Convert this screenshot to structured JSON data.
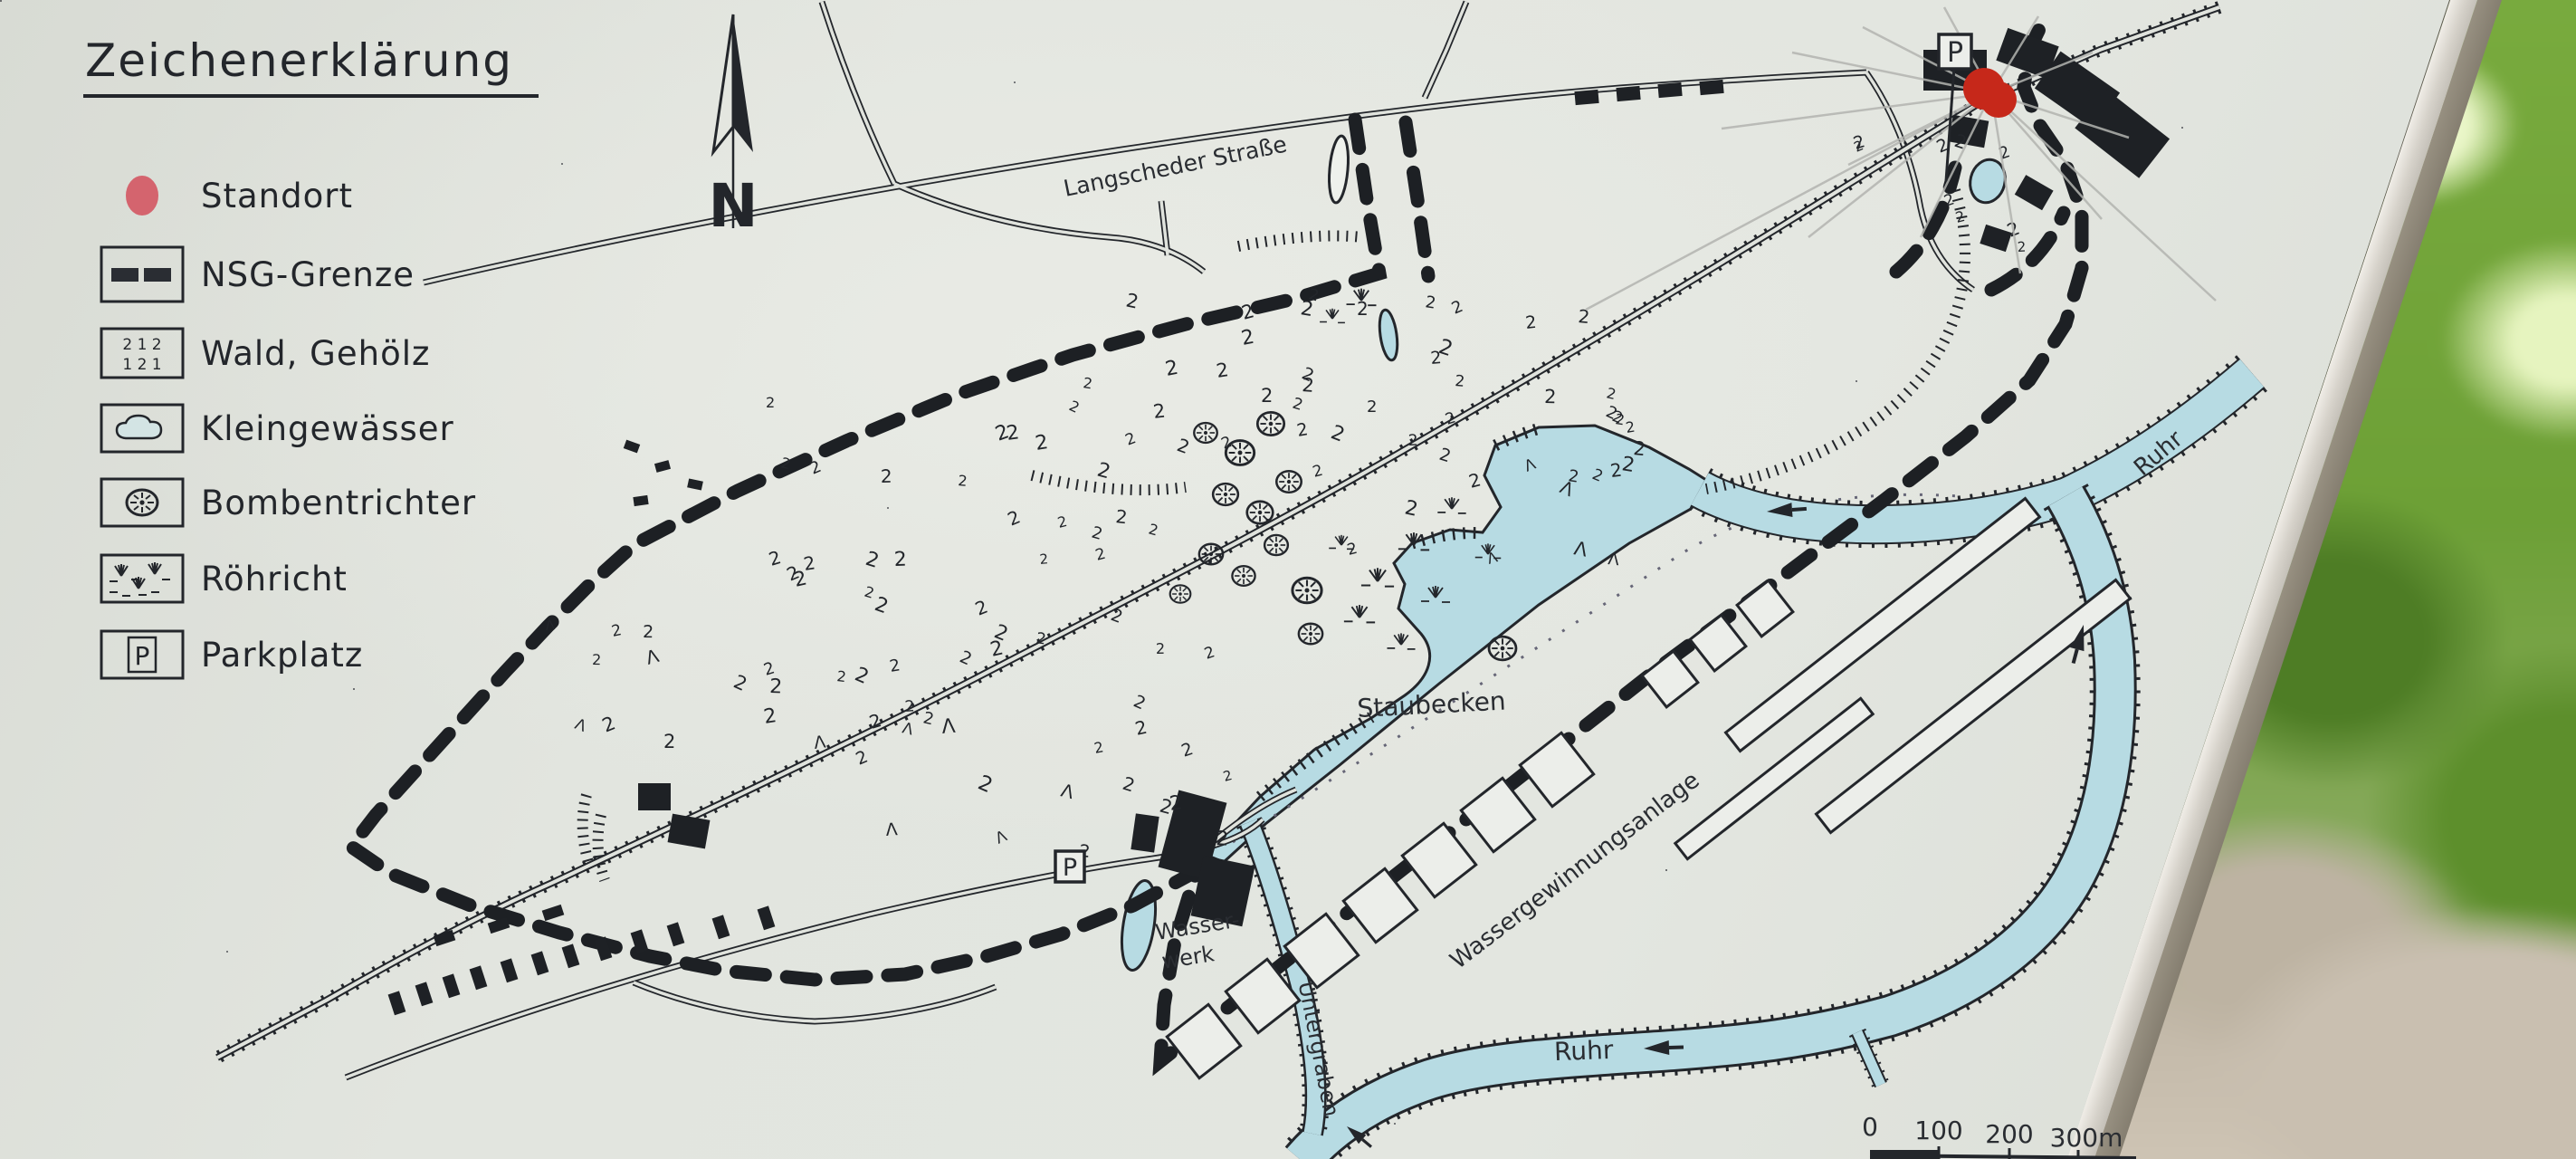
{
  "sign": {
    "legend": {
      "title": "Zeichenerklärung",
      "items": [
        {
          "symbol": "standort-dot",
          "label": "Standort"
        },
        {
          "symbol": "nsg-grenze-dashes",
          "label": "NSG-Grenze"
        },
        {
          "symbol": "wald-gehoelz-trees",
          "label": "Wald, Gehölz"
        },
        {
          "symbol": "kleingewaesser-pond",
          "label": "Kleingewässer"
        },
        {
          "symbol": "bombentrichter",
          "label": "Bombentrichter"
        },
        {
          "symbol": "roehricht-reeds",
          "label": "Röhricht"
        },
        {
          "symbol": "parkplatz-p",
          "label": "Parkplatz"
        }
      ],
      "parking_letter": "P",
      "wald_glyph_row1": "2  1  2",
      "wald_glyph_row2": "1  2  1"
    },
    "north_arrow_label": "N",
    "map": {
      "labels": {
        "street": "Langscheder Straße",
        "reservoir": "Staubecken",
        "water_extraction": "Wassergewinnungsanlage",
        "waterworks_line1": "Wasser-",
        "waterworks_line2": "werk",
        "channel": "Untergraben",
        "river_upper": "Ruhr",
        "river_lower": "Ruhr",
        "parking_marker": "P",
        "parking_marker_2": "P"
      },
      "tree_glyph": "2",
      "conifer_glyph": "Λ",
      "scale_bar": {
        "ticks": [
          "0",
          "100",
          "200",
          "300m"
        ]
      }
    },
    "colors": {
      "sign_bg": "#e0e3dd",
      "ink": "#23262b",
      "water": "#b7dbe3",
      "water_light": "#d3e4e4",
      "dot_red": "#c6281a",
      "legend_dot_red": "#d4646e",
      "foliage_green": "#76a93c",
      "gravel": "#c9bfb0",
      "frame_light": "#ddd9d1",
      "frame_dark": "#8a8274"
    }
  }
}
